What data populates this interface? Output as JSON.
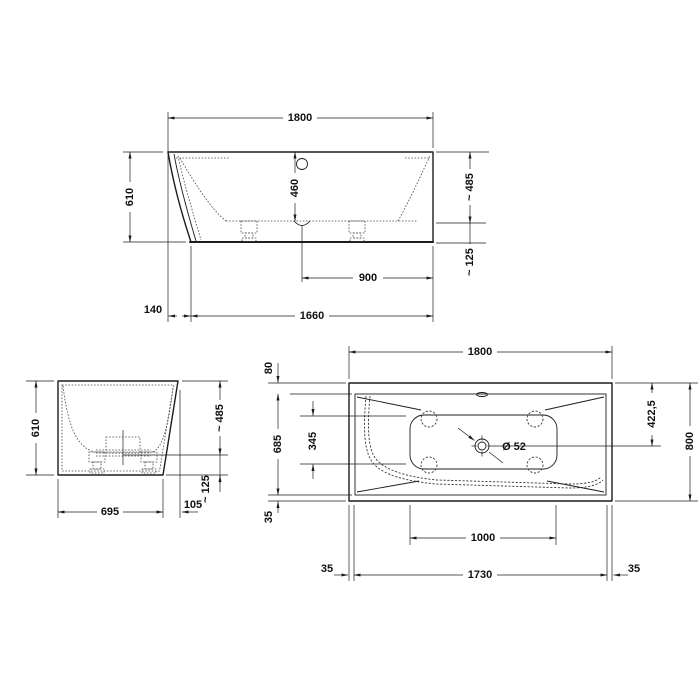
{
  "colors": {
    "line": "#1d1d1b",
    "background": "#ffffff"
  },
  "drawing": {
    "side_view": {
      "length": "1800",
      "height": "610",
      "inner_depth": "460",
      "rim_to_base": "~ 485",
      "base_to_floor": "~ 125",
      "drain_to_end": "900",
      "front_offset": "140",
      "bottom_length": "1660"
    },
    "end_view": {
      "height": "610",
      "rim_to_base": "~ 485",
      "base_to_floor": "~ 125",
      "bottom_width": "695",
      "side_offset": "105"
    },
    "plan_view": {
      "length": "1800",
      "rim_width_top": "80",
      "inner_length": "685",
      "basin_flat_width": "345",
      "drain_offset": "422,5",
      "width": "800",
      "drain_diameter": "Ø 52",
      "support_spacing": "1000",
      "bottom_length": "1730",
      "margin_left": "35",
      "margin_right": "35",
      "rim_width_bottom": "35"
    }
  }
}
